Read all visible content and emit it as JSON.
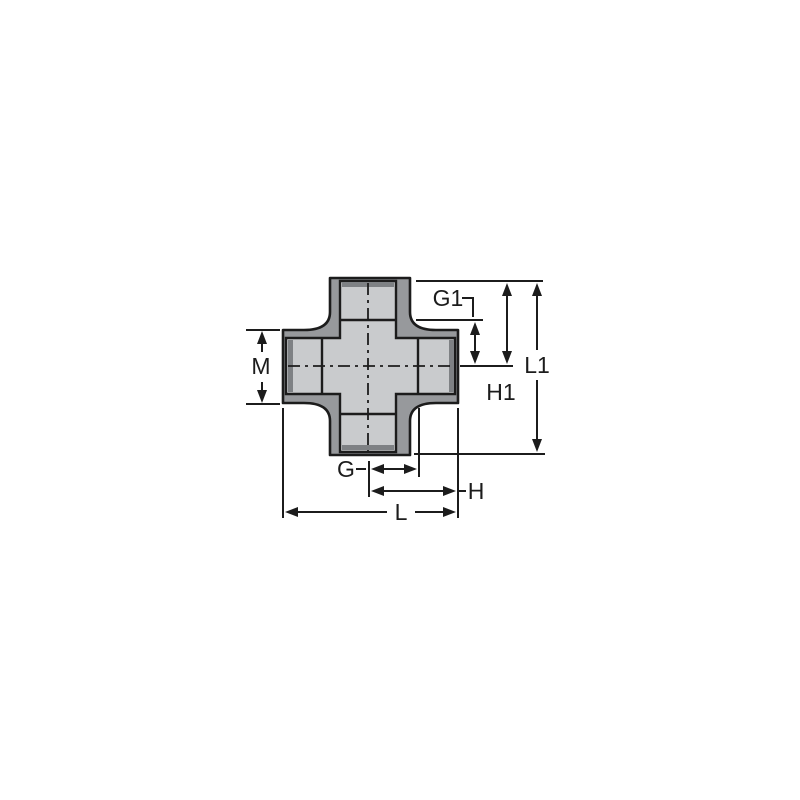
{
  "diagram": {
    "type": "technical-dimension-drawing",
    "subject": "socket cross pipe fitting, front section view with dimension callouts"
  },
  "labels": {
    "M": "M",
    "G": "G",
    "H": "H",
    "L": "L",
    "G1": "G1",
    "H1": "H1",
    "L1": "L1"
  },
  "colors": {
    "background": "#ffffff",
    "body_fill": "#97999c",
    "socket_fill": "#c9cbcd",
    "mouth_shade": "#7e8184",
    "line_color": "#1c1c1c"
  }
}
